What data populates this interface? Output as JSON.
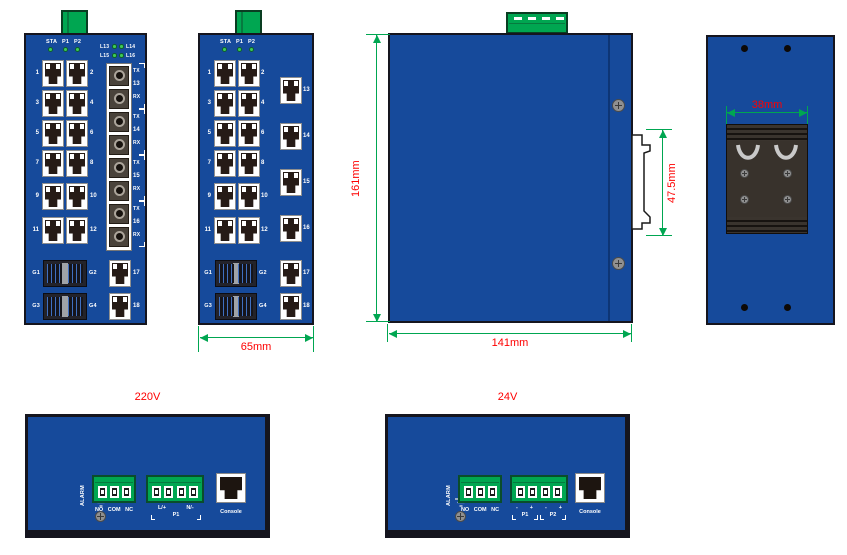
{
  "front_fiber": {
    "status_leds": [
      "STA",
      "P1",
      "P2"
    ],
    "link_led_rows": [
      [
        "L13",
        "L14"
      ],
      [
        "L15",
        "L16"
      ]
    ],
    "ports_left": [
      "1",
      "3",
      "5",
      "7",
      "9",
      "11"
    ],
    "ports_right": [
      "2",
      "4",
      "6",
      "8",
      "10",
      "12"
    ],
    "fiber_ports": [
      {
        "tx": "TX",
        "num": "13",
        "rx": "RX"
      },
      {
        "tx": "TX",
        "num": "14",
        "rx": "RX"
      },
      {
        "tx": "TX",
        "num": "15",
        "rx": "RX"
      },
      {
        "tx": "TX",
        "num": "16",
        "rx": "RX"
      }
    ],
    "sfp_rows": [
      {
        "left": "G1",
        "right": "G2",
        "combo": "17"
      },
      {
        "left": "G3",
        "right": "G4",
        "combo": "18"
      }
    ]
  },
  "front_copper": {
    "status_leds": [
      "STA",
      "P1",
      "P2"
    ],
    "ports_left": [
      "1",
      "3",
      "5",
      "7",
      "9",
      "11"
    ],
    "ports_right": [
      "2",
      "4",
      "6",
      "8",
      "10",
      "12"
    ],
    "ports_column": [
      "13",
      "14",
      "15",
      "16",
      "17",
      "18"
    ],
    "sfp_rows": [
      {
        "left": "G1",
        "right": "G2"
      },
      {
        "left": "G3",
        "right": "G4"
      }
    ],
    "width_dim": "65mm"
  },
  "side_view": {
    "height_dim": "161mm",
    "width_dim": "141mm",
    "clip_dim": "47.5mm"
  },
  "back_view": {
    "rail_dim": "38mm"
  },
  "power_220": {
    "title": "220V",
    "alarm_label": "ALARM",
    "relay_labels": "NO COM NC",
    "line_label": "L/+",
    "neutral_label": "N/-",
    "group_label": "P1",
    "console_label": "Console"
  },
  "power_24": {
    "title": "24V",
    "alarm_label": "ALARM",
    "relay_labels": "NO COM NC",
    "polarity": [
      "-",
      "+",
      "-",
      "+"
    ],
    "groups": [
      "P1",
      "P2"
    ],
    "console_label": "Console"
  },
  "colors": {
    "panel_blue": "#164A9B",
    "connector_green": "#00A651",
    "dimension_green": "#00A651",
    "dimension_red": "#FE0000"
  }
}
